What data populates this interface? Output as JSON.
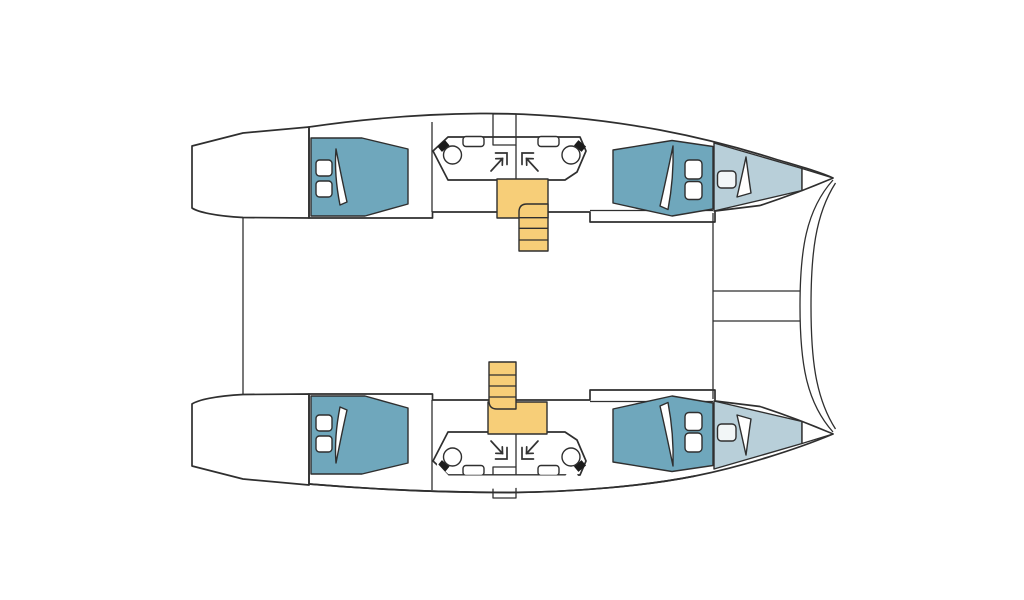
{
  "title": "Catamaran cabin layout floor plan (top view, bows to the right)",
  "diagram": {
    "type": "boat-floor-plan",
    "vessel": "sailing catamaran",
    "view": "top-down",
    "hulls": [
      "port-hull",
      "starboard-hull"
    ]
  },
  "colors": {
    "background": "#ffffff",
    "hull_interior": "#a8d8e9",
    "bed": "#6fa7bc",
    "bow_deck": "#b8cfd9",
    "bathroom": "#b8d88c",
    "stairs": "#f7ce78",
    "fixture_white": "#ffffff",
    "hatch": "#f2f6f7",
    "toilet_tank": "#1c1c1c",
    "outline": "#2f2f2f"
  },
  "features": {
    "double_cabins": 4,
    "beds": 4,
    "pillows": 8,
    "bathrooms": 4,
    "toilets": 4,
    "sinks": 4,
    "shower_corners": 4,
    "companionway_stairs": 2,
    "stair_steps_each": 4,
    "bow_hatches": 2,
    "bow_trampoline_lines": 2,
    "stern_platforms": 2
  },
  "areas": {
    "port_hull": [
      "aft-cabin",
      "aft-head",
      "forward-head",
      "forward-cabin",
      "bow-locker"
    ],
    "starboard_hull": [
      "aft-cabin",
      "aft-head",
      "forward-head",
      "forward-cabin",
      "bow-locker"
    ],
    "center": [
      "cockpit-deck",
      "saloon-deck",
      "bow-trampoline"
    ]
  }
}
